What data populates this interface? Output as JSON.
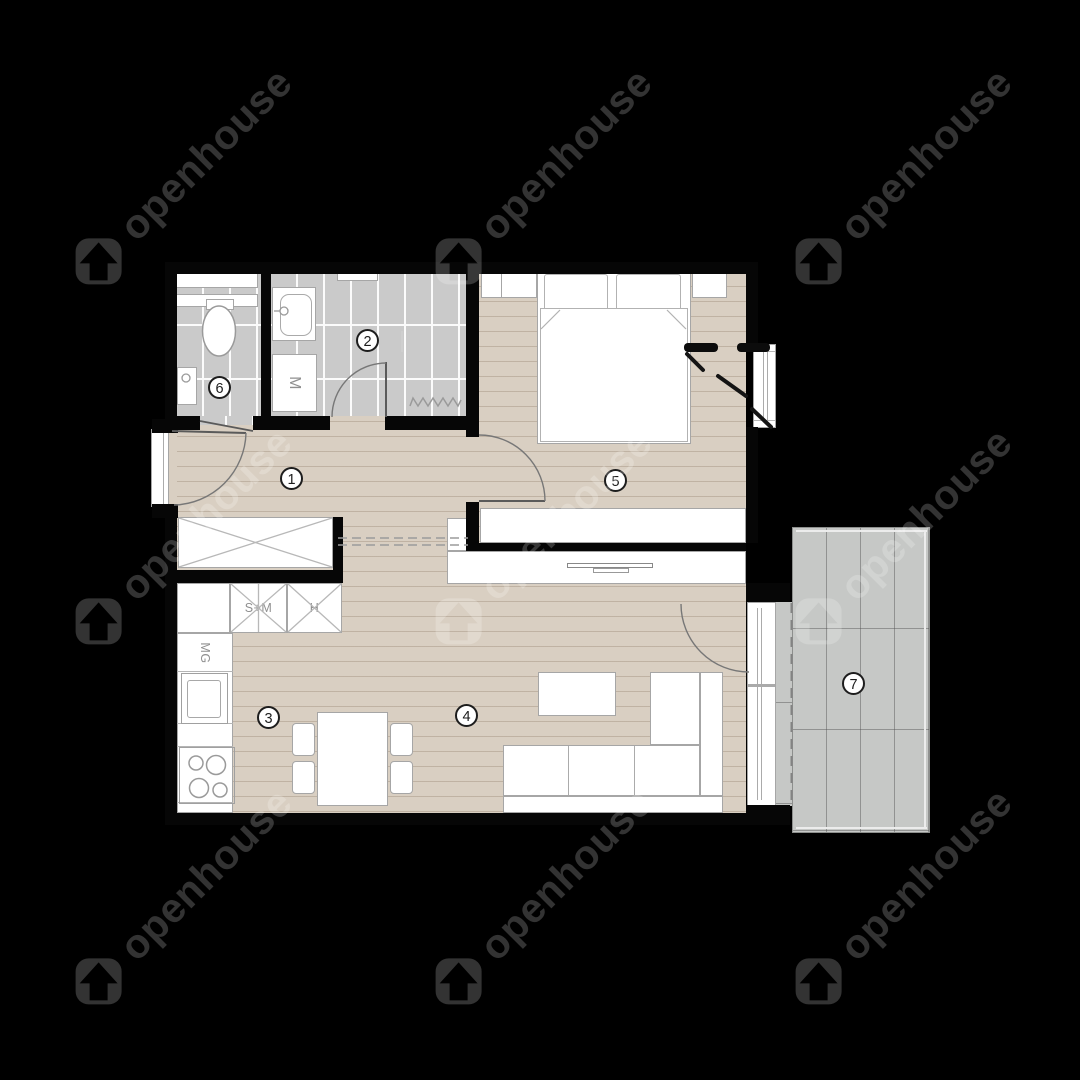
{
  "watermark": {
    "brand": "openhouse"
  },
  "colors": {
    "floor": "#d9cfc2",
    "tile": "#cacaca",
    "balcony": "#c6c8c6",
    "wall": "#060606",
    "wm": "#333333"
  },
  "floorplan": {
    "rooms": [
      {
        "number": "1",
        "name": "hallway"
      },
      {
        "number": "2",
        "name": "bathroom"
      },
      {
        "number": "3",
        "name": "kitchen"
      },
      {
        "number": "4",
        "name": "living-room"
      },
      {
        "number": "5",
        "name": "bedroom"
      },
      {
        "number": "6",
        "name": "wc"
      },
      {
        "number": "7",
        "name": "balcony"
      }
    ],
    "labels": {
      "washing_machine": "M",
      "dishwasher": "MG",
      "oven_microwave": "S+M",
      "fridge": "H"
    }
  }
}
